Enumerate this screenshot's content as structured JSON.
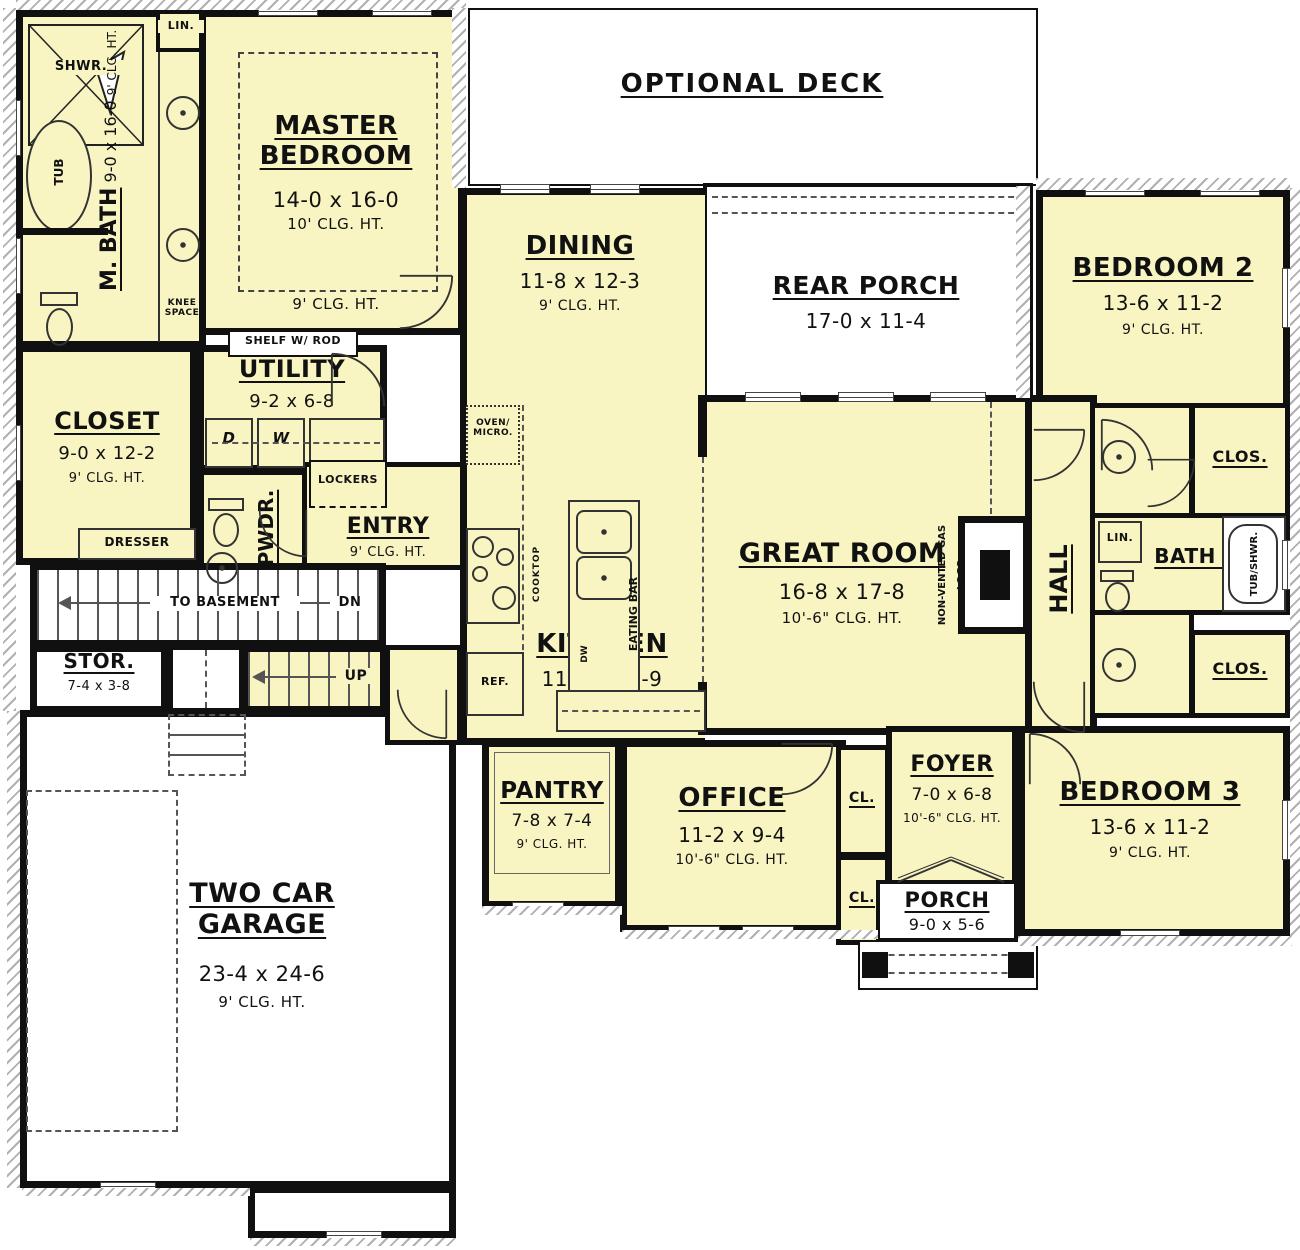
{
  "colors": {
    "room_fill": "#f8f5c2",
    "wall": "#101010",
    "hatch": "#b0b0b0"
  },
  "rooms": {
    "optional_deck": {
      "name": "OPTIONAL DECK"
    },
    "rear_porch": {
      "name": "REAR PORCH",
      "dims": "17-0 x 11-4"
    },
    "master_bedroom": {
      "name": "MASTER BEDROOM",
      "dims": "14-0 x 16-0",
      "clg": "10' CLG. HT.",
      "clg_outer": "9' CLG. HT."
    },
    "m_bath": {
      "name": "M. BATH",
      "dims": "9-0 x 16-0",
      "clg": "9' CLG. HT."
    },
    "closet": {
      "name": "CLOSET",
      "dims": "9-0 x 12-2",
      "clg": "9' CLG. HT."
    },
    "utility": {
      "name": "UTILITY",
      "dims": "9-2 x 6-8"
    },
    "pwdr": {
      "name": "PWDR."
    },
    "entry": {
      "name": "ENTRY",
      "clg": "9' CLG. HT."
    },
    "dining": {
      "name": "DINING",
      "dims": "11-8 x 12-3",
      "clg": "9' CLG. HT."
    },
    "kitchen": {
      "name": "KITCHEN",
      "dims": "11-8 x 16-9"
    },
    "great_room": {
      "name": "GREAT ROOM",
      "dims": "16-8 x 17-8",
      "clg": "10'-6\" CLG. HT."
    },
    "hall": {
      "name": "HALL"
    },
    "bath2": {
      "name": "BATH 2"
    },
    "bedroom2": {
      "name": "BEDROOM 2",
      "dims": "13-6 x 11-2",
      "clg": "9' CLG. HT."
    },
    "bedroom3": {
      "name": "BEDROOM 3",
      "dims": "13-6 x 11-2",
      "clg": "9' CLG. HT."
    },
    "office": {
      "name": "OFFICE",
      "dims": "11-2 x 9-4",
      "clg": "10'-6\" CLG. HT."
    },
    "pantry": {
      "name": "PANTRY",
      "dims": "7-8 x 7-4",
      "clg": "9' CLG. HT."
    },
    "foyer": {
      "name": "FOYER",
      "dims": "7-0 x 6-8",
      "clg": "10'-6\" CLG. HT."
    },
    "porch": {
      "name": "PORCH",
      "dims": "9-0 x 5-6"
    },
    "storage": {
      "name": "STOR.",
      "dims": "7-4 x 3-8"
    },
    "garage": {
      "name": "TWO CAR GARAGE",
      "dims": "23-4 x 24-6",
      "clg": "9' CLG. HT."
    }
  },
  "fixtures": {
    "shower": "SHWR.",
    "tub": "TUB",
    "linen_top": "LIN.",
    "knee_space": "KNEE SPACE",
    "shelf_rod": "SHELF W/ ROD",
    "dresser": "DRESSER",
    "dryer": "D",
    "washer": "W",
    "lockers": "LOCKERS",
    "oven_micro": "OVEN/ MICRO.",
    "cooktop": "COOKTOP",
    "fridge": "REF.",
    "eating_bar": "EATING BAR",
    "dishwasher": "DW",
    "gas_logs": "NON-VENTED GAS LOGS",
    "linen_hall": "LIN.",
    "tub_shwr": "TUB/SHWR.",
    "cl1": "CL.",
    "cl2": "CL.",
    "clos1": "CLOS.",
    "clos2": "CLOS."
  },
  "stairs": {
    "to_basement": "TO BASEMENT",
    "down": "DN",
    "up": "UP"
  }
}
